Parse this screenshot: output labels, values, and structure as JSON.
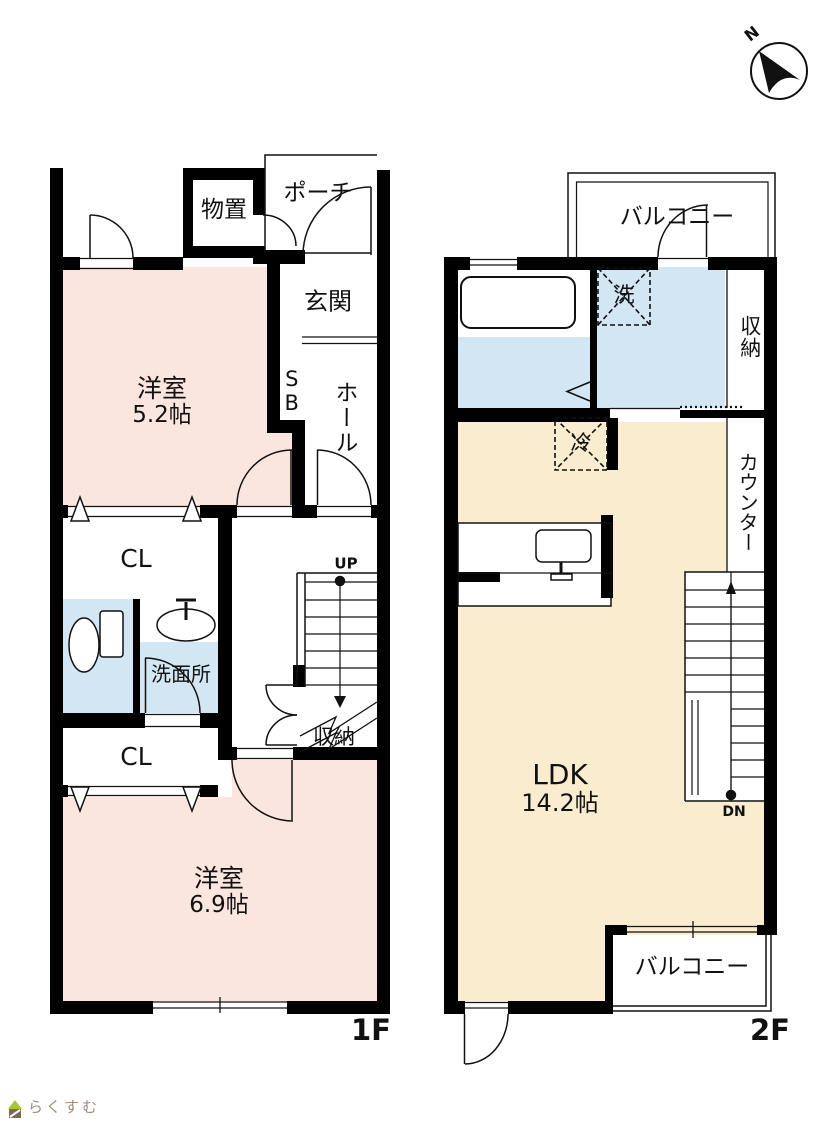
{
  "floor1": {
    "label": "1F",
    "stairs_up": "UP",
    "rooms": {
      "monooki": "物置",
      "porch": "ポーチ",
      "genkan": "玄関",
      "shoebox": "SB",
      "hall": "ホール",
      "bedroom1": {
        "name": "洋室",
        "size": "5.2帖"
      },
      "closet1": "CL",
      "washroom": "洗面所",
      "closet2": "CL",
      "storage": "収納",
      "bedroom2": {
        "name": "洋室",
        "size": "6.9帖"
      }
    }
  },
  "floor2": {
    "label": "2F",
    "stairs_down": "DN",
    "rooms": {
      "balcony_north": "バルコニー",
      "washer": "洗",
      "storage": "収納",
      "fridge": "冷",
      "counter": "カウンター",
      "ldk": {
        "name": "LDK",
        "size": "14.2帖"
      },
      "balcony_south": "バルコニー"
    }
  },
  "compass": {
    "north": "N"
  },
  "logo": {
    "text": "らくすむ"
  },
  "colors": {
    "bedroom_pink": "#fbe5df",
    "wet_area_blue": "#d3e6f3",
    "ldk_beige": "#faeccf",
    "wall_black": "#000000"
  }
}
